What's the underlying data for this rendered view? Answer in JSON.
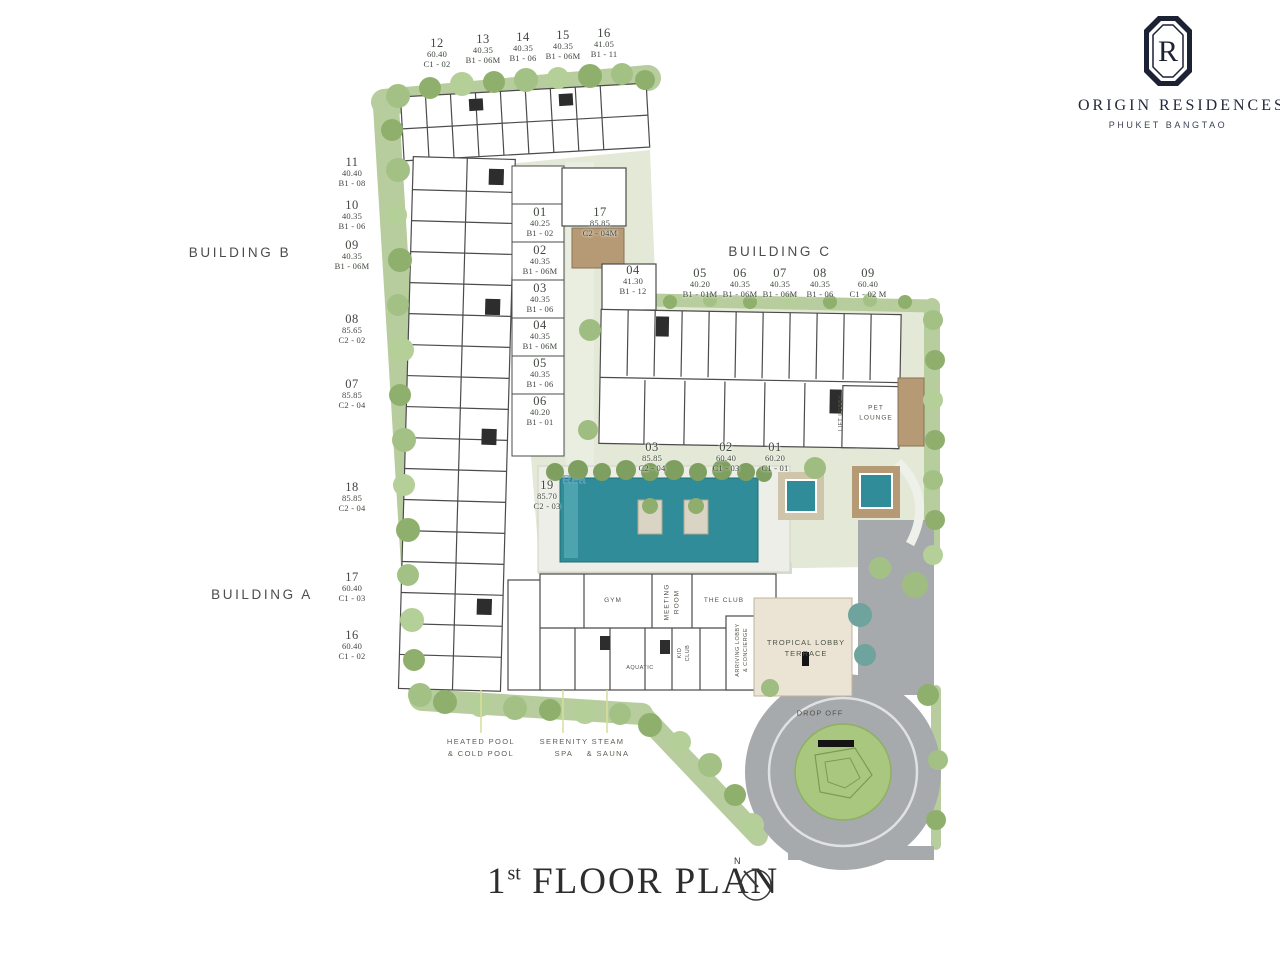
{
  "brand": {
    "logo_letter": "R",
    "name": "ORIGIN RESIDENCES",
    "subtitle": "PHUKET BANGTAO"
  },
  "title": {
    "number": "1",
    "ordinal": "st",
    "text": " FLOOR PLAN",
    "north": "N"
  },
  "building_labels": {
    "b": "BUILDING B",
    "c": "BUILDING C",
    "a": "BUILDING A"
  },
  "units": {
    "top_row": [
      {
        "no": "12",
        "area": "60.40",
        "type": "C1 - 02"
      },
      {
        "no": "13",
        "area": "40.35",
        "type": "B1 - 06M"
      },
      {
        "no": "14",
        "area": "40.35",
        "type": "B1 - 06"
      },
      {
        "no": "15",
        "area": "40.35",
        "type": "B1 - 06M"
      },
      {
        "no": "16",
        "area": "41.05",
        "type": "B1 - 11"
      }
    ],
    "left_col": [
      {
        "no": "11",
        "area": "40.40",
        "type": "B1 - 08"
      },
      {
        "no": "10",
        "area": "40.35",
        "type": "B1 - 06"
      },
      {
        "no": "09",
        "area": "40.35",
        "type": "B1 - 06M"
      },
      {
        "no": "08",
        "area": "85.65",
        "type": "C2 - 02"
      },
      {
        "no": "07",
        "area": "85.85",
        "type": "C2 - 04"
      },
      {
        "no": "18",
        "area": "85.85",
        "type": "C2 - 04"
      },
      {
        "no": "17",
        "area": "60.40",
        "type": "C1 - 03"
      },
      {
        "no": "16",
        "area": "60.40",
        "type": "C1 - 02"
      }
    ],
    "center_col": [
      {
        "no": "01",
        "area": "40.25",
        "type": "B1 - 02"
      },
      {
        "no": "02",
        "area": "40.35",
        "type": "B1 - 06M"
      },
      {
        "no": "03",
        "area": "40.35",
        "type": "B1 - 06"
      },
      {
        "no": "04",
        "area": "40.35",
        "type": "B1 - 06M"
      },
      {
        "no": "05",
        "area": "40.35",
        "type": "B1 - 06"
      },
      {
        "no": "06",
        "area": "40.20",
        "type": "B1 - 01"
      }
    ],
    "center_17": {
      "no": "17",
      "area": "85.85",
      "type": "C2 - 04M"
    },
    "center_04": {
      "no": "04",
      "area": "41.30",
      "type": "B1 - 12"
    },
    "c_row": [
      {
        "no": "05",
        "area": "40.20",
        "type": "B1 - 01M"
      },
      {
        "no": "06",
        "area": "40.35",
        "type": "B1 - 06M"
      },
      {
        "no": "07",
        "area": "40.35",
        "type": "B1 - 06M"
      },
      {
        "no": "08",
        "area": "40.35",
        "type": "B1 - 06"
      },
      {
        "no": "09",
        "area": "60.40",
        "type": "C1 - 02 M"
      }
    ],
    "pool_row": [
      {
        "no": "03",
        "area": "85.85",
        "type": "C2 - 04"
      },
      {
        "no": "02",
        "area": "60.40",
        "type": "C1 - 03"
      },
      {
        "no": "01",
        "area": "60.20",
        "type": "C1 - 01"
      }
    ],
    "unit_19": {
      "no": "19",
      "area": "85.70",
      "type": "C2 - 03"
    }
  },
  "rooms": {
    "gym": "GYM",
    "meeting_room": "MEETING\nROOM",
    "the_club": "THE CLUB",
    "tropical_lobby": "TROPICAL LOBBY\nTERRACE",
    "arriving_lobby": "ARRIVING LOBBY\n& CONCIERGE",
    "kid_club": "KID\nCLUB",
    "aquatic": "AQUATIC",
    "pet_lounge": "PET\nLOUNGE",
    "lift_lobby": "LIFT LOBBY",
    "drop_off": "DROP OFF"
  },
  "site_labels": {
    "heated_pool": "HEATED POOL\n& COLD POOL",
    "serenity_spa": "SERENITY\nSPA",
    "steam_sauna": "STEAM\n& SAUNA"
  },
  "watermark": "Rea",
  "colors": {
    "pool": "#2f8c98",
    "hedge": "#b7cd9d",
    "courtyard": "#e3e9d6",
    "road": "#a6aaad",
    "wood_deck": "#b69a75",
    "terrace": "#ebe4d4",
    "island_green": "#a9c77f",
    "logo_navy": "#1c2133"
  }
}
